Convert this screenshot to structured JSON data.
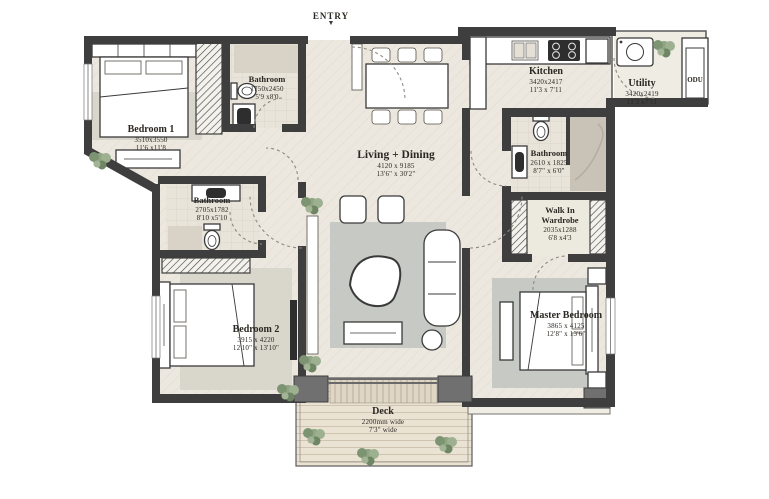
{
  "colors": {
    "wall": "#3e3e3e",
    "column": "#707070",
    "rug": "#c6c9c4",
    "rug_light": "#d9d6cc",
    "text": "#2b2722",
    "plant": "#86997f",
    "floor": "#ece8df",
    "deck": "#eae2d3"
  },
  "entry": {
    "label": "ENTRY",
    "arrow": "▼"
  },
  "rooms": {
    "bedroom1": {
      "name": "Bedroom 1",
      "mm": "3510x3550",
      "ft": "11'6 x11'8"
    },
    "bathroom1": {
      "name": "Bathroom",
      "mm": "1750x2450",
      "ft": "5'9 x8'0"
    },
    "bathroom2": {
      "name": "Bathroom",
      "mm": "2705x1782",
      "ft": "8'10 x5'10"
    },
    "living": {
      "name": "Living + Dining",
      "mm": "4120 x 9185",
      "ft": "13'6\" x 30'2\""
    },
    "kitchen": {
      "name": "Kitchen",
      "mm": "3420x2417",
      "ft": "11'3 x 7'11"
    },
    "utility": {
      "name": "Utility",
      "mm": "3420x2419",
      "ft": "11'3 x7'11"
    },
    "odu": {
      "name": "ODU"
    },
    "master_bathroom": {
      "name": "Bathroom",
      "mm": "2610 x 1825",
      "ft": "8'7\" x 6'0\""
    },
    "wardrobe": {
      "name": "Walk In Wardrobe",
      "mm": "2035x1288",
      "ft": "6'8 x4'3"
    },
    "master_bedroom": {
      "name": "Master Bedroom",
      "mm": "3865 x 4125",
      "ft": "12'8\" x 13'6\""
    },
    "bedroom2": {
      "name": "Bedroom 2",
      "mm": "3915 x 4220",
      "ft": "12'10\" x 13'10\""
    },
    "deck": {
      "name": "Deck",
      "mm": "2200mm wide",
      "ft": "7'3\" wide"
    }
  }
}
